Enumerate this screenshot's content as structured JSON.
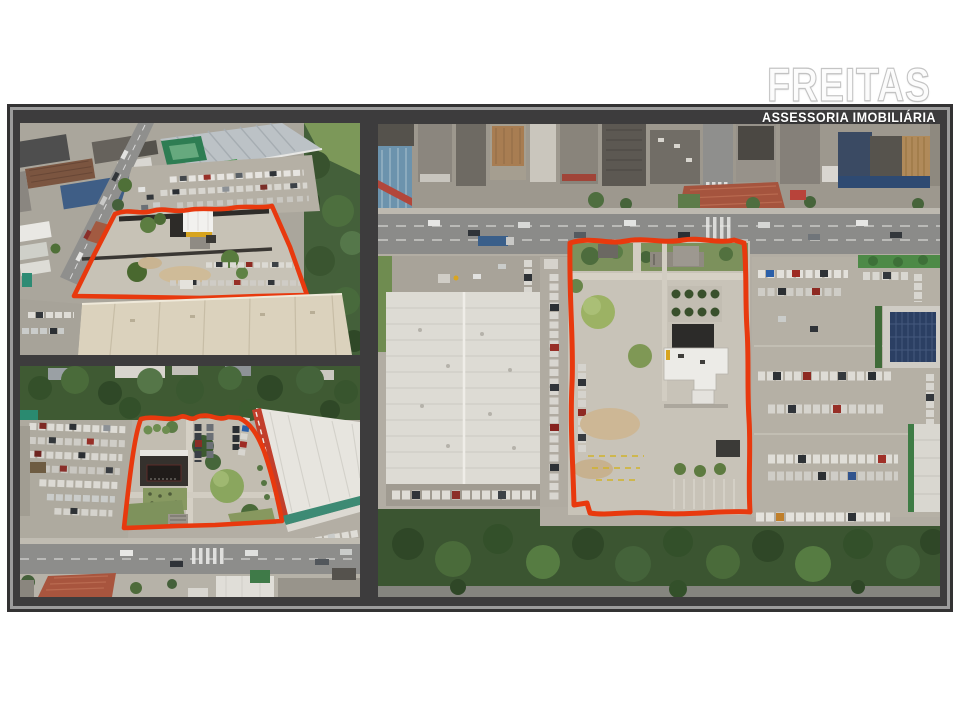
{
  "logo": {
    "brand": "FREITAS",
    "tagline": "ASSESSORIA IMOBILIÁRIA"
  },
  "colors": {
    "page_background": "#ffffff",
    "panel_gray": "#3d3c3d",
    "frame_line": "#9c9c9c",
    "boundary_red": "#e8390e",
    "vegetation_green": "#44603a",
    "pavement_gray": "#b2ada3",
    "warehouse_white": "#dddbd4"
  },
  "photos": {
    "top_left": {
      "name": "aerial-oblique-view-lot-outlined-red"
    },
    "bottom_left": {
      "name": "aerial-oblique-view-lot-front-street"
    },
    "right": {
      "name": "aerial-top-down-view-lot-outlined-red"
    }
  }
}
